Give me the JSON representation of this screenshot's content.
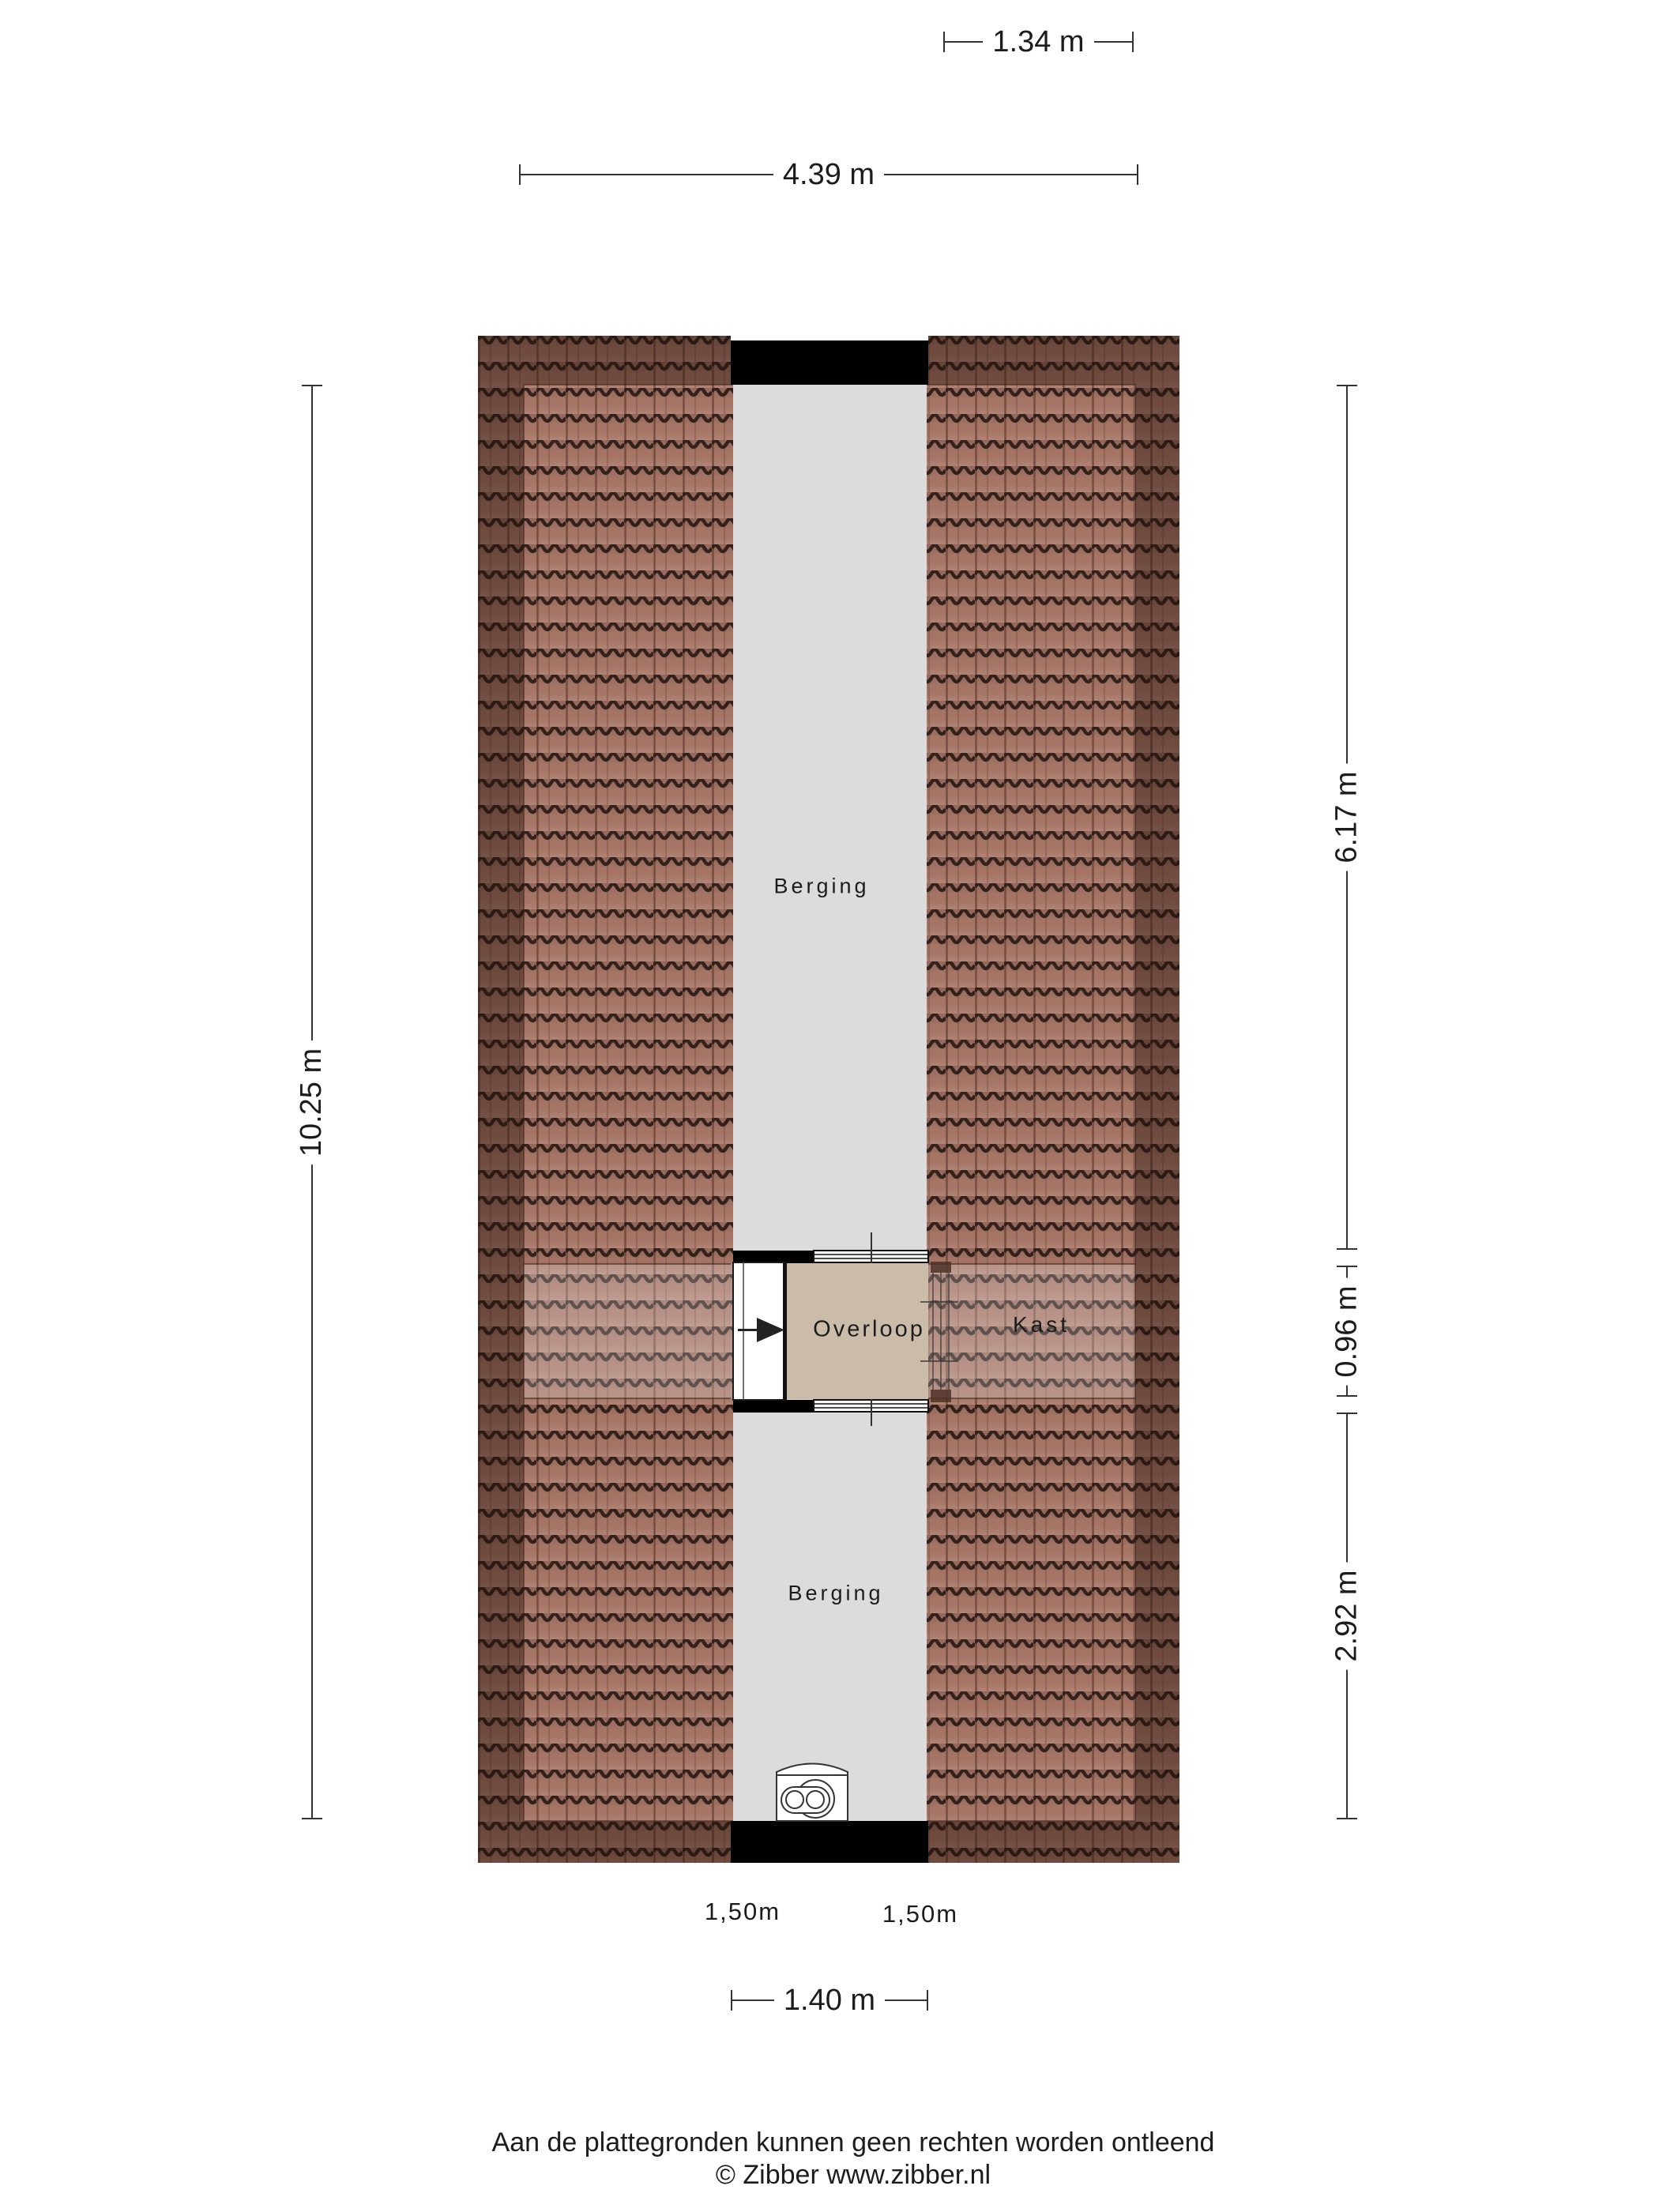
{
  "colors": {
    "strip": "#dcdcdc",
    "overloop": "#cbbcaa",
    "wall": "#000000",
    "dim": "#333333",
    "ink": "#1c1c1c",
    "tile": "#a97767"
  },
  "plan": {
    "rooms": {
      "berging_top": "Berging",
      "berging_bottom": "Berging",
      "overloop": "Overloop",
      "kast": "Kast"
    },
    "headroom": {
      "left": "1,50m",
      "right": "1,50m"
    }
  },
  "dimensions": {
    "kast_width": "1.34 m",
    "interior_width": "4.39 m",
    "interior_height": "10.25 m",
    "berging_top_height": "6.17 m",
    "overloop_height": "0.96 m",
    "berging_bottom_height": "2.92 m",
    "corridor_width": "1.40 m"
  },
  "footer": {
    "line1": "Aan de plattegronden kunnen geen rechten worden ontleend",
    "line2": "© Zibber www.zibber.nl"
  }
}
